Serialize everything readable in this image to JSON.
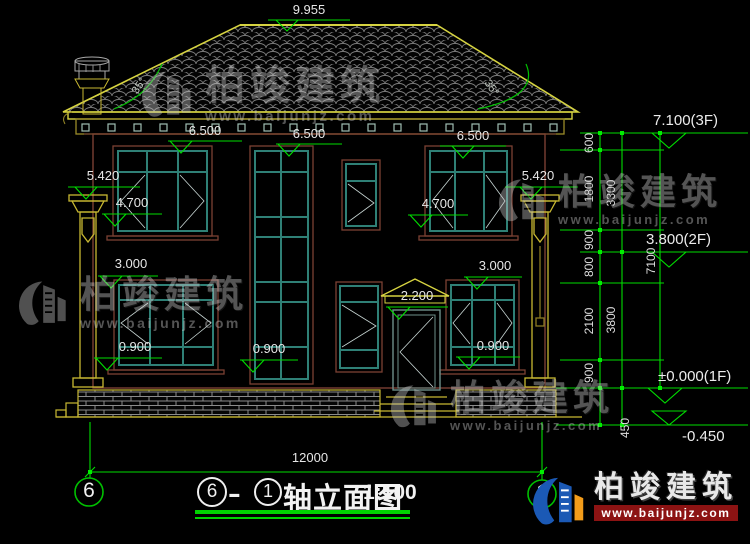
{
  "brand": {
    "name": "柏竣建筑",
    "url": "www.baijunjz.com"
  },
  "title": {
    "axis_from": "6",
    "dash": "-",
    "axis_to": "1",
    "name": "轴立面图",
    "scale": "1:100"
  },
  "axis_bubbles": {
    "left": "6",
    "right": "1"
  },
  "elevations": {
    "ridge": "9.955",
    "eave_1": "6.500",
    "eave_2": "6.500",
    "eave_3": "6.500",
    "left_parapet": "5.420",
    "left_lintel": "4.700",
    "left_window_top": "3.000",
    "left_sill": "0.900",
    "right_parapet": "5.420",
    "right_lintel": "4.700",
    "right_window_top": "3.000",
    "right_sill": "0.900",
    "center_sill": "0.900",
    "door_canopy": "2.200",
    "level_3f": "7.100(3F)",
    "level_2f": "3.800(2F)",
    "level_1f": "±0.000(1F)",
    "level_ground": "-0.450"
  },
  "dimensions": {
    "seg_600": "600",
    "seg_1800": "1800",
    "seg_900_a": "900",
    "seg_800": "800",
    "seg_2100": "2100",
    "seg_900_b": "900",
    "seg_450": "450",
    "sum_3300": "3300",
    "sum_3800": "3800",
    "total_7100": "7100",
    "total_width": "12000",
    "roof_angle_left": "35°",
    "roof_angle_right": "35°"
  }
}
